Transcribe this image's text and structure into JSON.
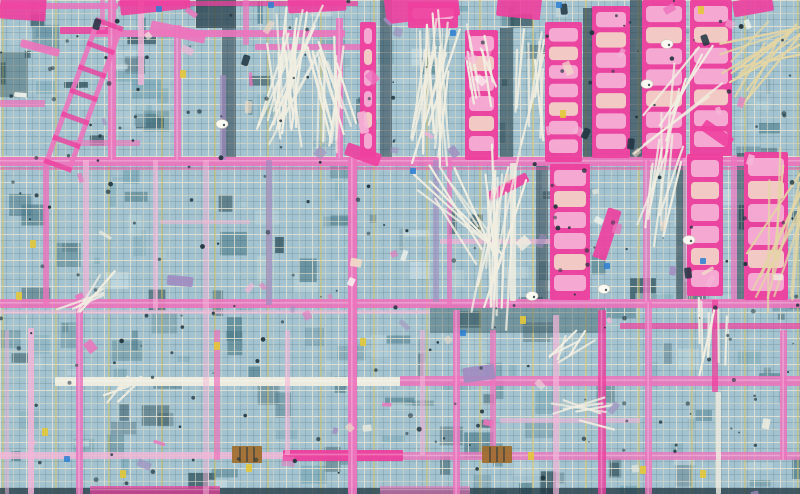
{
  "meta": {
    "description": "Aerial top-down photograph of a construction site floor deck: blue-grey rebar mesh grid crossed by pink and magenta formwork beams, hot-pink ladder-like formwork panels concentrated along the top and right, bundles of white rebar sticks, yellow scaffold lines, dark tie dots and scattered debris."
  },
  "palette": {
    "base_light": "#a2c3cf",
    "base_mid": "#7da9b8",
    "base_dark": "#4f7d8c",
    "deep": "#2e4f5a",
    "navy": "#1d3440",
    "mesh_dark": "#2b454e",
    "mesh_light": "#e2decb",
    "mesh_bright": "#f1ecdc",
    "scaffold_yellow": "#d9c45e",
    "pink": "#ec74bd",
    "hot_pink": "#ee3f9e",
    "rung_pink": "#f5b6d8",
    "cream": "#f2dcc8",
    "stick": "#f1eee1",
    "beige": "#e4d5a4",
    "purple": "#a08cc0",
    "dot": "#1f333c",
    "white": "#fafaf2",
    "brown": "#a06c2c",
    "yellow": "#e3c838",
    "blue": "#2d7fd3",
    "patch_light": "#c6dde6",
    "patch_teal": "#b7d2da"
  },
  "scene": {
    "width": 800,
    "height": 494,
    "seed": 11,
    "counts": {
      "patches": 260,
      "debris": 70,
      "dots": 200
    },
    "h_beams": [
      {
        "x": 0,
        "y": 3,
        "w": 118,
        "h": 6,
        "c": "pink",
        "o": 0.85
      },
      {
        "x": 118,
        "y": 1,
        "w": 240,
        "h": 5,
        "c": "hot_pink",
        "o": 0.75
      },
      {
        "x": 95,
        "y": 30,
        "w": 250,
        "h": 7,
        "c": "pink",
        "o": 0.9
      },
      {
        "x": 255,
        "y": 44,
        "w": 120,
        "h": 6,
        "c": "pink",
        "o": 0.85
      },
      {
        "x": 60,
        "y": 27,
        "w": 55,
        "h": 7,
        "c": "hot_pink",
        "o": 0.85
      },
      {
        "x": 0,
        "y": 100,
        "w": 45,
        "h": 7,
        "c": "pink",
        "o": 0.75
      },
      {
        "x": 70,
        "y": 140,
        "w": 70,
        "h": 6,
        "c": "pink",
        "o": 0.65
      },
      {
        "x": 0,
        "y": 157,
        "w": 800,
        "h": 9,
        "c": "pink",
        "o": 0.92
      },
      {
        "x": 0,
        "y": 167,
        "w": 800,
        "h": 3,
        "c": "hot_pink",
        "o": 0.45
      },
      {
        "x": 160,
        "y": 220,
        "w": 90,
        "h": 4,
        "c": "rung_pink",
        "o": 0.5
      },
      {
        "x": 440,
        "y": 239,
        "w": 112,
        "h": 5,
        "c": "rung_pink",
        "o": 0.7
      },
      {
        "x": 0,
        "y": 299,
        "w": 800,
        "h": 9,
        "c": "pink",
        "o": 0.9
      },
      {
        "x": 0,
        "y": 310,
        "w": 430,
        "h": 4,
        "c": "rung_pink",
        "o": 0.55
      },
      {
        "x": 620,
        "y": 323,
        "w": 180,
        "h": 6,
        "c": "hot_pink",
        "o": 0.7
      },
      {
        "x": 55,
        "y": 377,
        "w": 345,
        "h": 9,
        "c": "stick",
        "o": 0.95
      },
      {
        "x": 400,
        "y": 376,
        "w": 400,
        "h": 10,
        "c": "pink",
        "o": 0.88
      },
      {
        "x": 0,
        "y": 452,
        "w": 285,
        "h": 7,
        "c": "rung_pink",
        "o": 0.8
      },
      {
        "x": 283,
        "y": 450,
        "w": 120,
        "h": 11,
        "c": "hot_pink",
        "o": 0.95
      },
      {
        "x": 403,
        "y": 452,
        "w": 397,
        "h": 8,
        "c": "pink",
        "o": 0.8
      },
      {
        "x": 90,
        "y": 486,
        "w": 130,
        "h": 8,
        "c": "hot_pink",
        "o": 0.7
      },
      {
        "x": 380,
        "y": 486,
        "w": 90,
        "h": 8,
        "c": "pink",
        "o": 0.6
      },
      {
        "x": 500,
        "y": 418,
        "w": 140,
        "h": 5,
        "c": "rung_pink",
        "o": 0.6
      }
    ],
    "v_beams": [
      {
        "x": 100,
        "y": 0,
        "w": 5,
        "h": 30,
        "c": "pink",
        "o": 0.7
      },
      {
        "x": 108,
        "y": 0,
        "w": 8,
        "h": 160,
        "c": "pink",
        "o": 0.9
      },
      {
        "x": 138,
        "y": 0,
        "w": 6,
        "h": 85,
        "c": "rung_pink",
        "o": 0.8
      },
      {
        "x": 174,
        "y": 25,
        "w": 7,
        "h": 135,
        "c": "pink",
        "o": 0.8
      },
      {
        "x": 220,
        "y": 75,
        "w": 6,
        "h": 85,
        "c": "purple",
        "o": 0.7
      },
      {
        "x": 243,
        "y": 0,
        "w": 6,
        "h": 45,
        "c": "pink",
        "o": 0.7
      },
      {
        "x": 336,
        "y": 18,
        "w": 7,
        "h": 140,
        "c": "pink",
        "o": 0.9
      },
      {
        "x": 43,
        "y": 157,
        "w": 6,
        "h": 150,
        "c": "pink",
        "o": 0.8
      },
      {
        "x": 83,
        "y": 160,
        "w": 6,
        "h": 145,
        "c": "rung_pink",
        "o": 0.7
      },
      {
        "x": 153,
        "y": 160,
        "w": 5,
        "h": 150,
        "c": "rung_pink",
        "o": 0.6
      },
      {
        "x": 203,
        "y": 160,
        "w": 6,
        "h": 334,
        "c": "rung_pink",
        "o": 0.5
      },
      {
        "x": 266,
        "y": 160,
        "w": 6,
        "h": 145,
        "c": "purple",
        "o": 0.7
      },
      {
        "x": 348,
        "y": 157,
        "w": 9,
        "h": 337,
        "c": "pink",
        "o": 0.95
      },
      {
        "x": 433,
        "y": 160,
        "w": 6,
        "h": 142,
        "c": "purple",
        "o": 0.6
      },
      {
        "x": 447,
        "y": 160,
        "w": 5,
        "h": 148,
        "c": "pink",
        "o": 0.7
      },
      {
        "x": 510,
        "y": 163,
        "w": 6,
        "h": 138,
        "c": "stick",
        "o": 0.85
      },
      {
        "x": 643,
        "y": 160,
        "w": 7,
        "h": 142,
        "c": "pink",
        "o": 0.75
      },
      {
        "x": 683,
        "y": 155,
        "w": 5,
        "h": 145,
        "c": "rung_pink",
        "o": 0.6
      },
      {
        "x": 731,
        "y": 155,
        "w": 6,
        "h": 145,
        "c": "pink",
        "o": 0.7
      },
      {
        "x": 28,
        "y": 328,
        "w": 6,
        "h": 166,
        "c": "rung_pink",
        "o": 0.85
      },
      {
        "x": 5,
        "y": 330,
        "w": 4,
        "h": 164,
        "c": "rung_pink",
        "o": 0.5
      },
      {
        "x": 76,
        "y": 300,
        "w": 7,
        "h": 194,
        "c": "pink",
        "o": 0.85
      },
      {
        "x": 214,
        "y": 330,
        "w": 6,
        "h": 130,
        "c": "pink",
        "o": 0.7
      },
      {
        "x": 285,
        "y": 330,
        "w": 5,
        "h": 125,
        "c": "rung_pink",
        "o": 0.6
      },
      {
        "x": 420,
        "y": 330,
        "w": 5,
        "h": 125,
        "c": "rung_pink",
        "o": 0.6
      },
      {
        "x": 453,
        "y": 310,
        "w": 7,
        "h": 184,
        "c": "pink",
        "o": 0.85
      },
      {
        "x": 490,
        "y": 330,
        "w": 6,
        "h": 130,
        "c": "pink",
        "o": 0.75
      },
      {
        "x": 553,
        "y": 315,
        "w": 6,
        "h": 179,
        "c": "rung_pink",
        "o": 0.7
      },
      {
        "x": 598,
        "y": 310,
        "w": 8,
        "h": 184,
        "c": "hot_pink",
        "o": 0.8
      },
      {
        "x": 645,
        "y": 302,
        "w": 7,
        "h": 192,
        "c": "pink",
        "o": 0.8
      },
      {
        "x": 712,
        "y": 300,
        "w": 6,
        "h": 92,
        "c": "hot_pink",
        "o": 0.75
      },
      {
        "x": 716,
        "y": 392,
        "w": 5,
        "h": 102,
        "c": "stick",
        "o": 0.8
      },
      {
        "x": 780,
        "y": 330,
        "w": 7,
        "h": 130,
        "c": "pink",
        "o": 0.85
      }
    ],
    "shadows": [
      {
        "x": 196,
        "y": 0,
        "w": 40,
        "h": 28,
        "c": "navy",
        "o": 0.7
      },
      {
        "x": 222,
        "y": 28,
        "w": 14,
        "h": 130,
        "c": "navy",
        "o": 0.5
      },
      {
        "x": 380,
        "y": 0,
        "w": 12,
        "h": 160,
        "c": "navy",
        "o": 0.5
      },
      {
        "x": 500,
        "y": 28,
        "w": 13,
        "h": 132,
        "c": "navy",
        "o": 0.55
      },
      {
        "x": 583,
        "y": 8,
        "w": 10,
        "h": 150,
        "c": "navy",
        "o": 0.6
      },
      {
        "x": 630,
        "y": 0,
        "w": 12,
        "h": 158,
        "c": "navy",
        "o": 0.6
      },
      {
        "x": 536,
        "y": 164,
        "w": 12,
        "h": 136,
        "c": "navy",
        "o": 0.5
      },
      {
        "x": 676,
        "y": 153,
        "w": 10,
        "h": 146,
        "c": "navy",
        "o": 0.55
      },
      {
        "x": 737,
        "y": 153,
        "w": 7,
        "h": 147,
        "c": "navy",
        "o": 0.5
      },
      {
        "x": 430,
        "y": 305,
        "w": 175,
        "h": 28,
        "c": "deep",
        "o": 0.4
      },
      {
        "x": 0,
        "y": 52,
        "w": 28,
        "h": 45,
        "c": "deep",
        "o": 0.4
      },
      {
        "x": 0,
        "y": 488,
        "w": 800,
        "h": 6,
        "c": "navy",
        "o": 0.75
      }
    ],
    "panels": [
      {
        "x": 465,
        "y": 30,
        "w": 33,
        "h": 130,
        "n": 6
      },
      {
        "x": 545,
        "y": 22,
        "w": 37,
        "h": 140,
        "n": 7
      },
      {
        "x": 592,
        "y": 6,
        "w": 38,
        "h": 152,
        "n": 7
      },
      {
        "x": 642,
        "y": 0,
        "w": 44,
        "h": 158,
        "n": 7
      },
      {
        "x": 690,
        "y": 0,
        "w": 42,
        "h": 156,
        "n": 7
      },
      {
        "x": 550,
        "y": 164,
        "w": 40,
        "h": 136,
        "n": 6
      },
      {
        "x": 687,
        "y": 154,
        "w": 36,
        "h": 142,
        "n": 6
      },
      {
        "x": 744,
        "y": 152,
        "w": 44,
        "h": 148,
        "n": 6
      },
      {
        "x": 360,
        "y": 22,
        "w": 16,
        "h": 136,
        "n": 6
      },
      {
        "x": 408,
        "y": 2,
        "w": 50,
        "h": 26,
        "n": 1
      }
    ],
    "slabs": [
      {
        "x": 385,
        "y": -6,
        "w": 74,
        "h": 26,
        "r": -7,
        "c": "hot_pink"
      },
      {
        "x": 497,
        "y": -4,
        "w": 44,
        "h": 22,
        "r": 6,
        "c": "hot_pink"
      },
      {
        "x": 288,
        "y": -4,
        "w": 58,
        "h": 16,
        "r": -3,
        "c": "hot_pink"
      },
      {
        "x": 120,
        "y": -6,
        "w": 70,
        "h": 18,
        "r": -6,
        "c": "hot_pink"
      },
      {
        "x": 0,
        "y": -4,
        "w": 46,
        "h": 24,
        "r": 4,
        "c": "hot_pink"
      },
      {
        "x": 733,
        "y": -2,
        "w": 40,
        "h": 16,
        "r": -10,
        "c": "hot_pink"
      },
      {
        "x": 345,
        "y": 148,
        "w": 36,
        "h": 13,
        "r": 20,
        "c": "hot_pink"
      },
      {
        "x": 600,
        "y": 208,
        "w": 14,
        "h": 52,
        "r": 18,
        "c": "hot_pink"
      },
      {
        "x": 486,
        "y": 182,
        "w": 44,
        "h": 10,
        "r": -28,
        "c": "hot_pink"
      },
      {
        "x": 20,
        "y": 44,
        "w": 40,
        "h": 8,
        "r": 15,
        "c": "pink"
      },
      {
        "x": 150,
        "y": 26,
        "w": 56,
        "h": 12,
        "r": 12,
        "c": "pink"
      },
      {
        "x": 700,
        "y": 128,
        "w": 34,
        "h": 12,
        "r": 35,
        "c": "hot_pink"
      },
      {
        "x": 463,
        "y": 366,
        "w": 32,
        "h": 15,
        "r": -8,
        "c": "purple"
      },
      {
        "x": 167,
        "y": 276,
        "w": 26,
        "h": 10,
        "r": 5,
        "c": "purple"
      },
      {
        "x": 352,
        "y": 118,
        "w": 22,
        "h": 9,
        "r": 80,
        "c": "rung_pink"
      }
    ],
    "ladder": {
      "x": 70,
      "y": 90,
      "rot": 20,
      "len": 150,
      "gap": 24,
      "rw": 5,
      "n": 7
    },
    "bundles": [
      {
        "x": 287,
        "y": 80,
        "l": 95,
        "s": 38,
        "n": 22,
        "r": 10,
        "c": "stick"
      },
      {
        "x": 333,
        "y": 92,
        "l": 80,
        "s": 30,
        "n": 16,
        "r": -6,
        "c": "stick"
      },
      {
        "x": 430,
        "y": 92,
        "l": 110,
        "s": 30,
        "n": 18,
        "r": 8,
        "c": "stick"
      },
      {
        "x": 477,
        "y": 72,
        "l": 60,
        "s": 26,
        "n": 7,
        "r": -12,
        "c": "stick"
      },
      {
        "x": 530,
        "y": 85,
        "l": 75,
        "s": 22,
        "n": 9,
        "r": 4,
        "c": "stick"
      },
      {
        "x": 764,
        "y": 55,
        "l": 80,
        "s": 60,
        "n": 14,
        "r": 55,
        "c": "beige"
      },
      {
        "x": 782,
        "y": 230,
        "l": 110,
        "s": 40,
        "n": 12,
        "r": 20,
        "c": "beige"
      },
      {
        "x": 497,
        "y": 235,
        "l": 125,
        "s": 26,
        "n": 15,
        "r": 6,
        "c": "stick"
      },
      {
        "x": 462,
        "y": 215,
        "l": 90,
        "s": 55,
        "n": 8,
        "r": -40,
        "c": "stick"
      },
      {
        "x": 660,
        "y": 185,
        "l": 90,
        "s": 30,
        "n": 9,
        "r": 12,
        "c": "stick"
      },
      {
        "x": 712,
        "y": 330,
        "l": 55,
        "s": 20,
        "n": 7,
        "r": 5,
        "c": "stick"
      },
      {
        "x": 92,
        "y": 300,
        "l": 45,
        "s": 70,
        "n": 5,
        "r": 60,
        "c": "stick"
      },
      {
        "x": 585,
        "y": 415,
        "l": 45,
        "s": 80,
        "n": 6,
        "r": 70,
        "c": "stick"
      },
      {
        "x": 130,
        "y": 390,
        "l": 30,
        "s": 80,
        "n": 4,
        "r": 50,
        "c": "stick"
      },
      {
        "x": 680,
        "y": 100,
        "l": 90,
        "s": 50,
        "n": 8,
        "r": 30,
        "c": "stick"
      },
      {
        "x": 570,
        "y": 345,
        "l": 35,
        "s": 60,
        "n": 5,
        "r": 40,
        "c": "stick"
      }
    ],
    "helmets": [
      {
        "x": 667,
        "y": 44
      },
      {
        "x": 647,
        "y": 84
      },
      {
        "x": 604,
        "y": 289
      },
      {
        "x": 532,
        "y": 296
      },
      {
        "x": 222,
        "y": 124
      },
      {
        "x": 689,
        "y": 240
      }
    ],
    "workers": [
      {
        "x": 585,
        "y": 127
      },
      {
        "x": 700,
        "y": 36
      },
      {
        "x": 244,
        "y": 54
      },
      {
        "x": 95,
        "y": 18
      },
      {
        "x": 628,
        "y": 138
      },
      {
        "x": 560,
        "y": 4
      },
      {
        "x": 684,
        "y": 268
      }
    ],
    "pallets": [
      {
        "x": 232,
        "y": 446
      },
      {
        "x": 482,
        "y": 446
      }
    ],
    "yellow_bits": [
      {
        "x": 16,
        "y": 292
      },
      {
        "x": 42,
        "y": 428
      },
      {
        "x": 214,
        "y": 342
      },
      {
        "x": 520,
        "y": 316
      },
      {
        "x": 560,
        "y": 110
      },
      {
        "x": 700,
        "y": 470
      },
      {
        "x": 360,
        "y": 338
      },
      {
        "x": 528,
        "y": 452
      },
      {
        "x": 120,
        "y": 470
      },
      {
        "x": 246,
        "y": 464
      },
      {
        "x": 640,
        "y": 466
      },
      {
        "x": 698,
        "y": 6
      },
      {
        "x": 30,
        "y": 240
      },
      {
        "x": 180,
        "y": 70
      }
    ],
    "blue_bits": [
      {
        "x": 268,
        "y": 2
      },
      {
        "x": 556,
        "y": 2
      },
      {
        "x": 410,
        "y": 168
      },
      {
        "x": 604,
        "y": 263
      },
      {
        "x": 460,
        "y": 330
      },
      {
        "x": 64,
        "y": 456
      },
      {
        "x": 700,
        "y": 258
      },
      {
        "x": 156,
        "y": 6
      },
      {
        "x": 450,
        "y": 30
      }
    ]
  }
}
